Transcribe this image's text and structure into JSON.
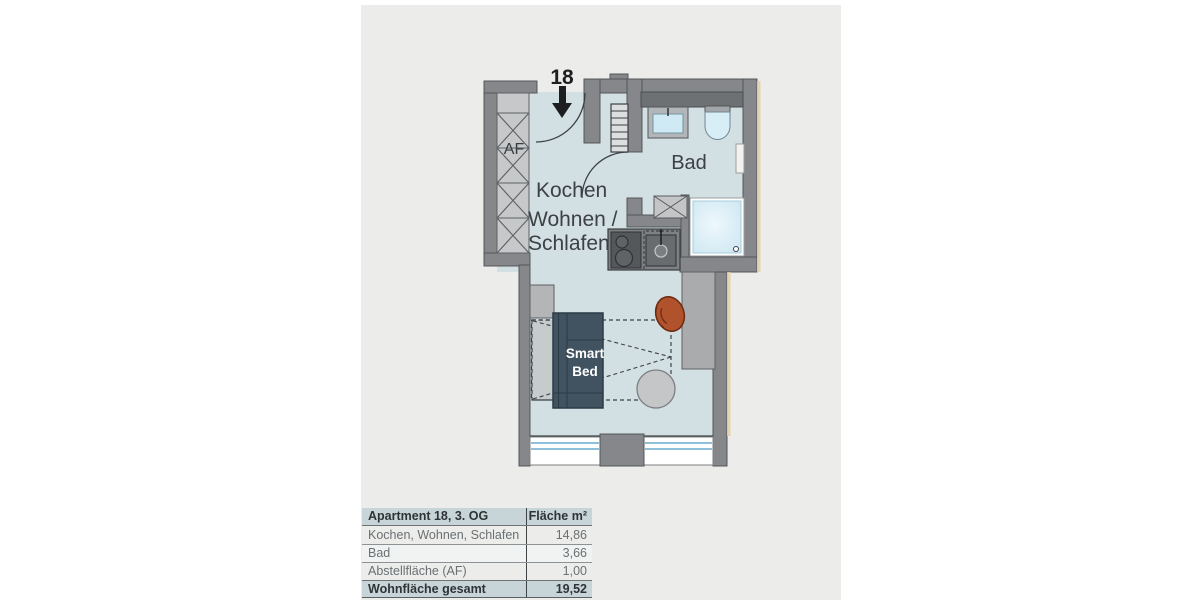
{
  "plan": {
    "number": "18",
    "labels": {
      "storage": "AF",
      "bath": "Bad",
      "room_line1": "Kochen",
      "room_line2": "Wohnen /",
      "room_line3": "Schlafen",
      "bed_line1": "Smart",
      "bed_line2": "Bed"
    }
  },
  "table": {
    "header": {
      "title": "Apartment 18, 3. OG",
      "area_label": "Fläche m²"
    },
    "rows": [
      {
        "label": "Kochen, Wohnen, Schlafen",
        "value": "14,86"
      },
      {
        "label": "Bad",
        "value": "3,66"
      },
      {
        "label": "Abstellfläche (AF)",
        "value": "1,00"
      }
    ],
    "total": {
      "label": "Wohnfläche gesamt",
      "value": "19,52"
    }
  },
  "colors": {
    "panel_bg": "#ececea",
    "floor": "#d3e0e3",
    "wall": "#85878a",
    "storage_box": "#c6c8c9",
    "counter_dark": "#6e7173",
    "fixture_blue": "#d7eef7",
    "bed": "#415260",
    "chair": "#b0522c",
    "furniture_gray": "#a9abad",
    "window_glass": "#8fc0da",
    "edge_tan": "#e3cfa6",
    "table_header_bg": "#c8d5d8"
  }
}
